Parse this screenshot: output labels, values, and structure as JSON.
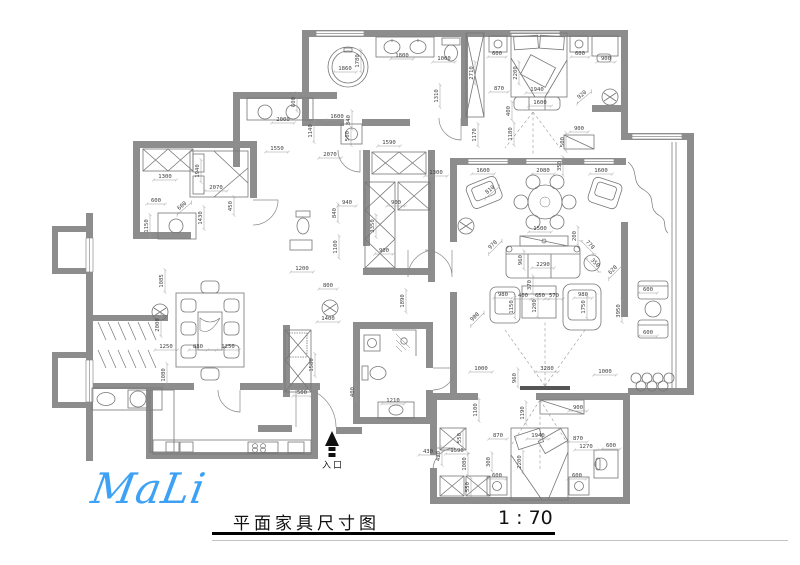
{
  "meta": {
    "title": "平面家具尺寸图",
    "scale": "1 : 70",
    "logo": "MaLi",
    "entrance_label": "入口"
  },
  "colors": {
    "wall": "#8d8d8d",
    "furniture_line": "#767676",
    "dim_text": "#3f3f3f",
    "logo_blue": "#3da2f5",
    "title_rule": "#000000"
  },
  "dims": [
    {
      "x": 345,
      "y": 70,
      "t": "1860"
    },
    {
      "x": 359,
      "y": 61,
      "t": "1780",
      "r": -90
    },
    {
      "x": 402,
      "y": 57,
      "t": "1800"
    },
    {
      "x": 444,
      "y": 60,
      "t": "1000"
    },
    {
      "x": 438,
      "y": 96,
      "t": "1310",
      "r": -90
    },
    {
      "x": 473,
      "y": 73,
      "t": "2710",
      "r": -90
    },
    {
      "x": 476,
      "y": 135,
      "t": "1170",
      "r": -90
    },
    {
      "x": 497,
      "y": 55,
      "t": "600"
    },
    {
      "x": 580,
      "y": 55,
      "t": "600"
    },
    {
      "x": 606,
      "y": 60,
      "t": "900"
    },
    {
      "x": 517,
      "y": 73,
      "t": "2200",
      "r": -90
    },
    {
      "x": 537,
      "y": 91,
      "t": "1940"
    },
    {
      "x": 499,
      "y": 90,
      "t": "870"
    },
    {
      "x": 583,
      "y": 96,
      "t": "920",
      "r": -40
    },
    {
      "x": 540,
      "y": 104,
      "t": "1600"
    },
    {
      "x": 510,
      "y": 111,
      "t": "400",
      "r": -90
    },
    {
      "x": 512,
      "y": 134,
      "t": "1180",
      "r": -90
    },
    {
      "x": 579,
      "y": 130,
      "t": "900"
    },
    {
      "x": 564,
      "y": 142,
      "t": "500",
      "r": -90
    },
    {
      "x": 283,
      "y": 121,
      "t": "2000"
    },
    {
      "x": 295,
      "y": 102,
      "t": "600",
      "r": -90
    },
    {
      "x": 312,
      "y": 131,
      "t": "1140",
      "r": -90
    },
    {
      "x": 337,
      "y": 118,
      "t": "1600"
    },
    {
      "x": 350,
      "y": 120,
      "t": "840",
      "r": -90
    },
    {
      "x": 349,
      "y": 136,
      "t": "500",
      "r": -90
    },
    {
      "x": 277,
      "y": 150,
      "t": "1550"
    },
    {
      "x": 330,
      "y": 156,
      "t": "2070"
    },
    {
      "x": 389,
      "y": 144,
      "t": "1590"
    },
    {
      "x": 436,
      "y": 174,
      "t": "1300"
    },
    {
      "x": 165,
      "y": 178,
      "t": "1300"
    },
    {
      "x": 199,
      "y": 171,
      "t": "1940",
      "r": -90
    },
    {
      "x": 216,
      "y": 189,
      "t": "2070"
    },
    {
      "x": 156,
      "y": 202,
      "t": "600"
    },
    {
      "x": 183,
      "y": 207,
      "t": "600",
      "r": -40
    },
    {
      "x": 148,
      "y": 226,
      "t": "1150",
      "r": -90
    },
    {
      "x": 202,
      "y": 218,
      "t": "1430",
      "r": -90
    },
    {
      "x": 232,
      "y": 206,
      "t": "450",
      "r": -90
    },
    {
      "x": 347,
      "y": 204,
      "t": "940"
    },
    {
      "x": 336,
      "y": 213,
      "t": "840",
      "r": -90
    },
    {
      "x": 396,
      "y": 204,
      "t": "900"
    },
    {
      "x": 374,
      "y": 226,
      "t": "3350",
      "r": -90
    },
    {
      "x": 337,
      "y": 247,
      "t": "1100",
      "r": -90
    },
    {
      "x": 302,
      "y": 270,
      "t": "1200"
    },
    {
      "x": 328,
      "y": 287,
      "t": "800"
    },
    {
      "x": 384,
      "y": 252,
      "t": "900"
    },
    {
      "x": 404,
      "y": 301,
      "t": "1890",
      "r": -90
    },
    {
      "x": 328,
      "y": 320,
      "t": "1400"
    },
    {
      "x": 483,
      "y": 172,
      "t": "1600"
    },
    {
      "x": 543,
      "y": 172,
      "t": "2080"
    },
    {
      "x": 601,
      "y": 172,
      "t": "1600"
    },
    {
      "x": 561,
      "y": 166,
      "t": "350",
      "r": -90
    },
    {
      "x": 491,
      "y": 191,
      "t": "810",
      "r": -40
    },
    {
      "x": 540,
      "y": 230,
      "t": "1500"
    },
    {
      "x": 576,
      "y": 236,
      "t": "200",
      "r": -90
    },
    {
      "x": 543,
      "y": 266,
      "t": "2290"
    },
    {
      "x": 522,
      "y": 260,
      "t": "960",
      "r": -90
    },
    {
      "x": 494,
      "y": 246,
      "t": "970",
      "r": -45
    },
    {
      "x": 589,
      "y": 246,
      "t": "770",
      "r": 45
    },
    {
      "x": 594,
      "y": 264,
      "t": "350",
      "r": 45
    },
    {
      "x": 531,
      "y": 285,
      "t": "370",
      "r": -90
    },
    {
      "x": 503,
      "y": 296,
      "t": "980"
    },
    {
      "x": 523,
      "y": 297,
      "t": "400"
    },
    {
      "x": 540,
      "y": 297,
      "t": "650"
    },
    {
      "x": 554,
      "y": 297,
      "t": "570"
    },
    {
      "x": 583,
      "y": 296,
      "t": "980"
    },
    {
      "x": 513,
      "y": 307,
      "t": "1150",
      "r": -90
    },
    {
      "x": 536,
      "y": 306,
      "t": "1200",
      "r": -90
    },
    {
      "x": 585,
      "y": 307,
      "t": "1750",
      "r": -90
    },
    {
      "x": 476,
      "y": 318,
      "t": "900",
      "r": -45
    },
    {
      "x": 481,
      "y": 370,
      "t": "1000"
    },
    {
      "x": 547,
      "y": 370,
      "t": "3280"
    },
    {
      "x": 516,
      "y": 378,
      "t": "960",
      "r": -90
    },
    {
      "x": 620,
      "y": 311,
      "t": "3950",
      "r": -90
    },
    {
      "x": 648,
      "y": 291,
      "t": "600"
    },
    {
      "x": 648,
      "y": 334,
      "t": "600"
    },
    {
      "x": 614,
      "y": 271,
      "t": "620",
      "r": -45
    },
    {
      "x": 605,
      "y": 373,
      "t": "1000"
    },
    {
      "x": 477,
      "y": 410,
      "t": "1100",
      "r": -90
    },
    {
      "x": 524,
      "y": 413,
      "t": "1190",
      "r": -90
    },
    {
      "x": 578,
      "y": 409,
      "t": "900"
    },
    {
      "x": 498,
      "y": 437,
      "t": "870"
    },
    {
      "x": 538,
      "y": 437,
      "t": "1940"
    },
    {
      "x": 578,
      "y": 440,
      "t": "870"
    },
    {
      "x": 586,
      "y": 448,
      "t": "1270"
    },
    {
      "x": 611,
      "y": 447,
      "t": "600"
    },
    {
      "x": 490,
      "y": 462,
      "t": "300",
      "r": -90
    },
    {
      "x": 521,
      "y": 462,
      "t": "2200",
      "r": -90
    },
    {
      "x": 497,
      "y": 477,
      "t": "600"
    },
    {
      "x": 577,
      "y": 477,
      "t": "600"
    },
    {
      "x": 302,
      "y": 394,
      "t": "500"
    },
    {
      "x": 354,
      "y": 392,
      "t": "400",
      "r": -90
    },
    {
      "x": 393,
      "y": 402,
      "t": "1210"
    },
    {
      "x": 461,
      "y": 438,
      "t": "550",
      "r": -90
    },
    {
      "x": 428,
      "y": 453,
      "t": "430"
    },
    {
      "x": 440,
      "y": 456,
      "t": "420",
      "r": -90
    },
    {
      "x": 457,
      "y": 452,
      "t": "1590"
    },
    {
      "x": 466,
      "y": 464,
      "t": "1080",
      "r": -90
    },
    {
      "x": 469,
      "y": 487,
      "t": "550",
      "r": -90
    },
    {
      "x": 163,
      "y": 281,
      "t": "1085",
      "r": -90
    },
    {
      "x": 159,
      "y": 325,
      "t": "2000",
      "r": -90
    },
    {
      "x": 166,
      "y": 348,
      "t": "1250"
    },
    {
      "x": 198,
      "y": 348,
      "t": "880"
    },
    {
      "x": 228,
      "y": 348,
      "t": "1250"
    },
    {
      "x": 165,
      "y": 375,
      "t": "1080",
      "r": -90
    },
    {
      "x": 313,
      "y": 365,
      "t": "1580",
      "r": -90
    }
  ]
}
